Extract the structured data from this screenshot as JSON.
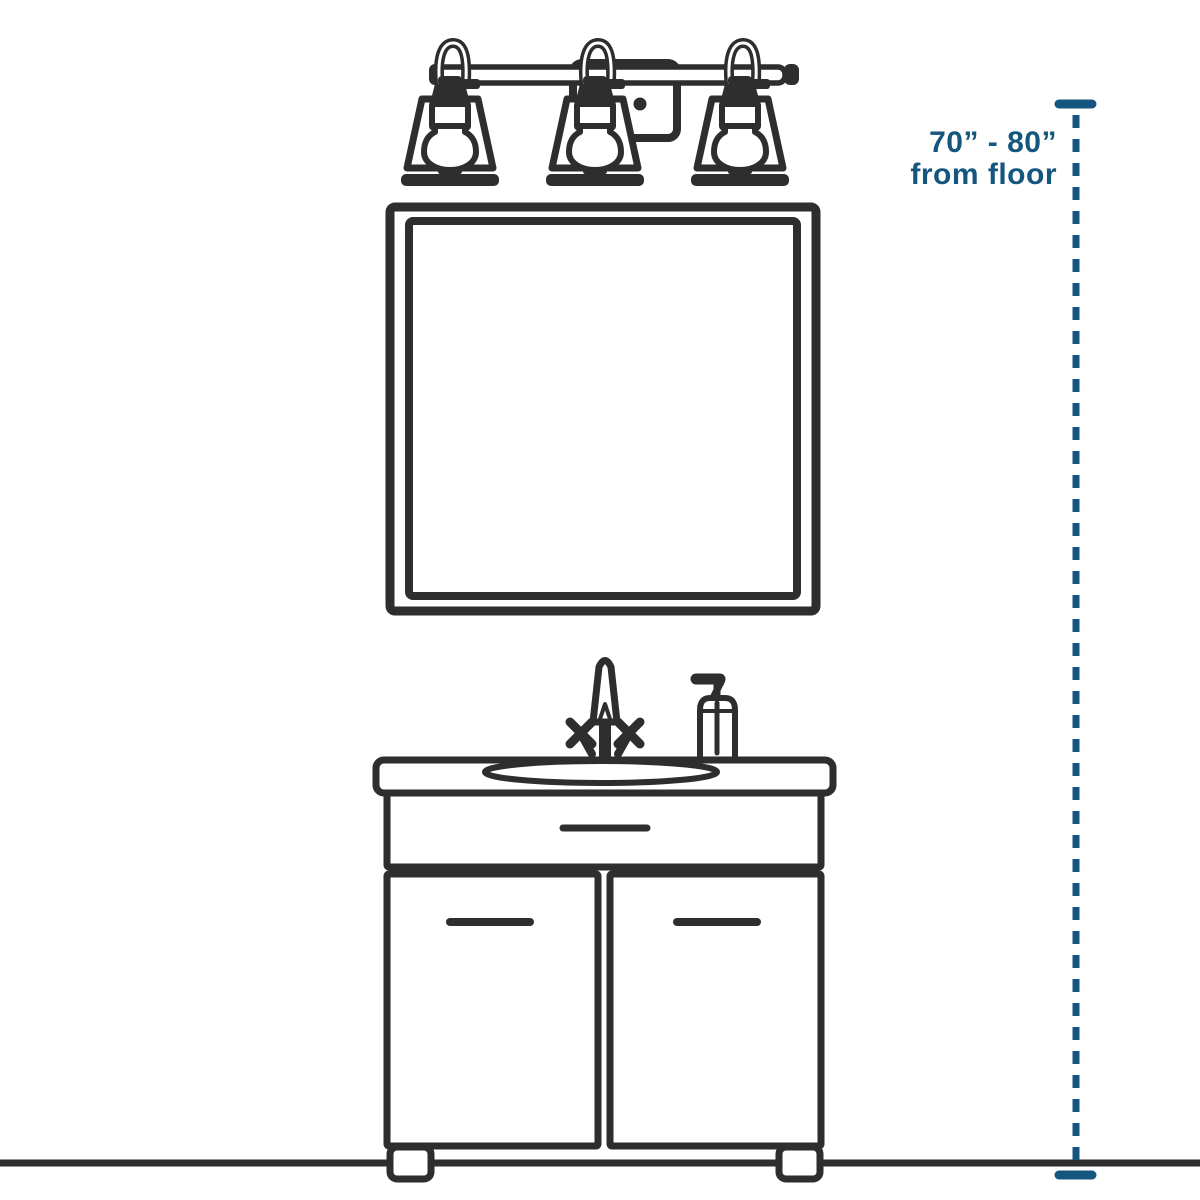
{
  "canvas": {
    "background": "#ffffff"
  },
  "colors": {
    "ink": "#2e2e2e",
    "accent": "#14567d"
  },
  "annotation": {
    "range_label": "70” - 80”",
    "source_label": "from floor"
  },
  "parts": [
    "vanity-light-fixture",
    "mirror",
    "faucet",
    "soap-dispenser",
    "sink",
    "drawer",
    "cabinet-doors",
    "feet",
    "floor-line",
    "height-measurement-line"
  ]
}
